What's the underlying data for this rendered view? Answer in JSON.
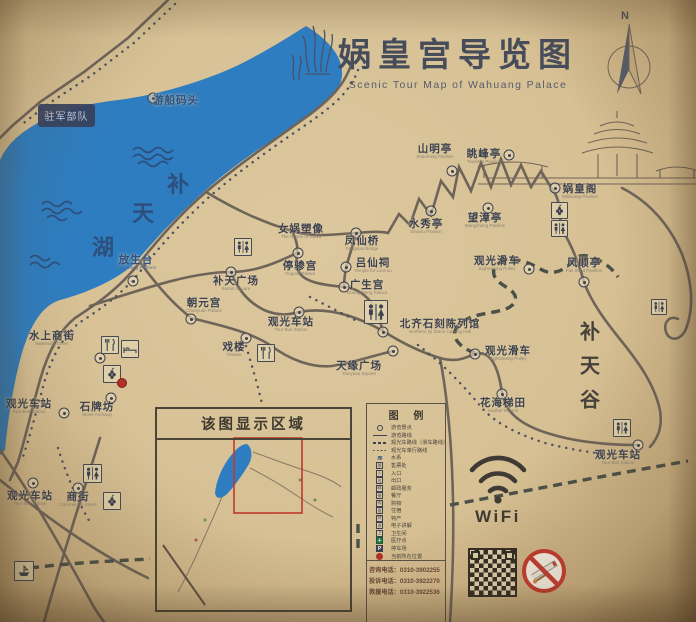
{
  "title": {
    "zh": "娲皇宫导览图",
    "en": "Scenic Tour Map of Wahuang Palace"
  },
  "compass": {
    "label": "N"
  },
  "military_area": {
    "label": "驻军部队"
  },
  "wifi": {
    "label": "WiFi"
  },
  "inset": {
    "title": "该图显示区域"
  },
  "legend": {
    "title": "图 例",
    "items": [
      {
        "sym": "dot",
        "label": "游览景点"
      },
      {
        "sym": "solid",
        "label": "游览路线"
      },
      {
        "sym": "dash",
        "label": "观光车路线（滑车路线）"
      },
      {
        "sym": "dots",
        "label": "观光车单行路线"
      },
      {
        "sym": "wave",
        "label": "水系",
        "glyph": "≋"
      },
      {
        "sym": "box",
        "label": "售票处",
        "glyph": "票"
      },
      {
        "sym": "box",
        "label": "入口",
        "glyph": "入"
      },
      {
        "sym": "box",
        "label": "出口",
        "glyph": "出"
      },
      {
        "sym": "box",
        "label": "邮政服务",
        "glyph": "邮"
      },
      {
        "sym": "box",
        "label": "餐厅",
        "glyph": "餐"
      },
      {
        "sym": "box",
        "label": "购物",
        "glyph": "购"
      },
      {
        "sym": "box",
        "label": "住宿",
        "glyph": "宿"
      },
      {
        "sym": "box",
        "label": "特产",
        "glyph": "特"
      },
      {
        "sym": "box",
        "label": "电子讲解",
        "glyph": "讲"
      },
      {
        "sym": "box",
        "label": "卫生间",
        "glyph": "卫"
      },
      {
        "sym": "med",
        "label": "医疗点",
        "glyph": "+"
      },
      {
        "sym": "park",
        "label": "停车场",
        "glyph": "P"
      },
      {
        "sym": "cur",
        "label": "当前所在位置"
      }
    ]
  },
  "phones": {
    "lines": [
      "咨询电话：0310-3902255",
      "投诉电话：0310-3922270",
      "救援电话：0310-3922536"
    ]
  },
  "lake": {
    "chars": [
      {
        "ch": "补",
        "x": 178,
        "y": 183
      },
      {
        "ch": "天",
        "x": 143,
        "y": 212
      },
      {
        "ch": "湖",
        "x": 103,
        "y": 246
      }
    ]
  },
  "valley": {
    "chars": [
      {
        "ch": "补",
        "x": 590,
        "y": 330
      },
      {
        "ch": "天",
        "x": 590,
        "y": 364
      },
      {
        "ch": "谷",
        "x": 590,
        "y": 398
      }
    ]
  },
  "pois": [
    {
      "zh": "山明亭",
      "en": "Shanming Pavilion",
      "x": 435,
      "y": 152,
      "mx": 452,
      "my": 171
    },
    {
      "zh": "眺峰亭",
      "en": "Tiaofeng Pavilion",
      "x": 484,
      "y": 157,
      "mx": 509,
      "my": 155
    },
    {
      "zh": "娲皇阁",
      "en": "Wahuang Pavilion",
      "x": 580,
      "y": 192,
      "mx": 555,
      "my": 188
    },
    {
      "zh": "水秀亭",
      "en": "Shuixiu Pavilion",
      "x": 426,
      "y": 227,
      "mx": 431,
      "my": 211
    },
    {
      "zh": "望漳亭",
      "en": "Wangzhang Pavilion",
      "x": 485,
      "y": 221,
      "mx": 488,
      "my": 208
    },
    {
      "zh": "风顺亭",
      "en": "Fair Wind Pavilion",
      "x": 584,
      "y": 266,
      "mx": 584,
      "my": 282
    },
    {
      "zh": "观光滑车",
      "en": "Sightseeing Pulley",
      "x": 497,
      "y": 264,
      "mx": 529,
      "my": 269
    },
    {
      "zh": "观光滑车",
      "en": "Sightseeing Pulley",
      "x": 508,
      "y": 354,
      "mx": 475,
      "my": 354
    },
    {
      "zh": "女娲塑像",
      "en": "The Statue of Nuwa",
      "x": 301,
      "y": 232
    },
    {
      "zh": "凤仙桥",
      "en": "Fengxian Bridge",
      "x": 362,
      "y": 244,
      "mx": 356,
      "my": 233
    },
    {
      "zh": "停骖宫",
      "en": "Tingcan Palace",
      "x": 300,
      "y": 269,
      "mx": 298,
      "my": 253
    },
    {
      "zh": "吕仙祠",
      "en": "Temple for Lord Lu",
      "x": 373,
      "y": 266,
      "mx": 346,
      "my": 267
    },
    {
      "zh": "补天广场",
      "en": "Butian Square",
      "x": 236,
      "y": 284,
      "mx": 231,
      "my": 272
    },
    {
      "zh": "广生宫",
      "en": "Guangsheng Palace",
      "x": 367,
      "y": 288,
      "mx": 344,
      "my": 287
    },
    {
      "zh": "朝元宫",
      "en": "Chaoyuan Palace",
      "x": 204,
      "y": 306,
      "mx": 191,
      "my": 319
    },
    {
      "zh": "观光车站",
      "en": "Tour Bus Station",
      "x": 291,
      "y": 325,
      "mx": 299,
      "my": 312
    },
    {
      "zh": "戏楼",
      "en": "Theatre",
      "x": 234,
      "y": 350,
      "mx": 246,
      "my": 338
    },
    {
      "zh": "北齐石刻陈列馆",
      "en": "Northern Qi Stone Carving Hall",
      "x": 440,
      "y": 327,
      "mx": 383,
      "my": 332
    },
    {
      "zh": "天缘广场",
      "en": "Tianyuan Square",
      "x": 359,
      "y": 369,
      "mx": 393,
      "my": 351
    },
    {
      "zh": "花海梯田",
      "en": "Huahai Terrace",
      "x": 503,
      "y": 406,
      "mx": 502,
      "my": 394
    },
    {
      "zh": "放生台",
      "en": "Fangsheng Platform",
      "x": 136,
      "y": 263,
      "mx": 133,
      "my": 281,
      "blue": true
    },
    {
      "zh": "游船码头",
      "en": "",
      "x": 176,
      "y": 101,
      "mx": 153,
      "my": 98,
      "blue": true
    },
    {
      "zh": "水上商街",
      "en": "Waterside Street",
      "x": 52,
      "y": 339,
      "mx": 100,
      "my": 358
    },
    {
      "zh": "石牌坊",
      "en": "Stone Archway",
      "x": 97,
      "y": 410,
      "mx": 111,
      "my": 398
    },
    {
      "zh": "观光车站",
      "en": "Tour Bus Station",
      "x": 29,
      "y": 407,
      "mx": 64,
      "my": 413
    },
    {
      "zh": "商街",
      "en": "Commercial Street",
      "x": 78,
      "y": 500,
      "mx": 78,
      "my": 488
    },
    {
      "zh": "观光车站",
      "en": "Tour Bus Station",
      "x": 30,
      "y": 499,
      "mx": 33,
      "my": 483
    },
    {
      "zh": "观光车站",
      "en": "Tour Bus Station",
      "x": 618,
      "y": 458,
      "mx": 638,
      "my": 445
    }
  ],
  "icons": [
    {
      "t": "toilet",
      "x": 234,
      "y": 238,
      "s": 16
    },
    {
      "t": "toilet",
      "x": 364,
      "y": 300,
      "s": 22
    },
    {
      "t": "specialty",
      "x": 551,
      "y": 202,
      "s": 15
    },
    {
      "t": "toilet",
      "x": 551,
      "y": 220,
      "s": 15
    },
    {
      "t": "restaurant",
      "x": 257,
      "y": 344,
      "s": 16
    },
    {
      "t": "restaurant",
      "x": 101,
      "y": 336,
      "s": 16
    },
    {
      "t": "hotel",
      "x": 121,
      "y": 340,
      "s": 16
    },
    {
      "t": "specialty",
      "x": 103,
      "y": 365,
      "s": 16
    },
    {
      "t": "toilet",
      "x": 83,
      "y": 464,
      "s": 17
    },
    {
      "t": "specialty",
      "x": 103,
      "y": 492,
      "s": 16
    },
    {
      "t": "toilet",
      "x": 613,
      "y": 419,
      "s": 16
    },
    {
      "t": "toilet",
      "x": 651,
      "y": 299,
      "s": 14
    },
    {
      "t": "boat",
      "x": 14,
      "y": 561,
      "s": 18
    },
    {
      "t": "current",
      "x": 122,
      "y": 383
    }
  ],
  "colors": {
    "lake": "#2e7dc0",
    "paper": "#d7c196",
    "road": "#6e645a",
    "label": "#3d4251",
    "accent_red": "#c0392b"
  }
}
